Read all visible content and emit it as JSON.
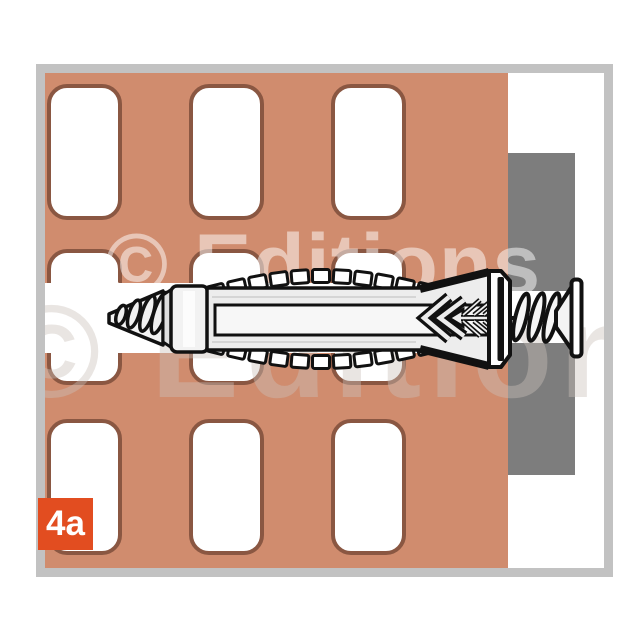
{
  "illustration": {
    "step_label": "4a",
    "watermark_line1": "© Editions",
    "watermark_line2": "© Editions"
  },
  "colors": {
    "brick": "#D08C6E",
    "brick_hole_border": "#8A5742",
    "frame_gray": "#C2C2C2",
    "panel_gray": "#7D7D7D",
    "outline_black": "#111111",
    "plug_fill": "#EDEDED",
    "step_label_bg": "#E24D20",
    "step_label_text": "#FFFFFF"
  }
}
